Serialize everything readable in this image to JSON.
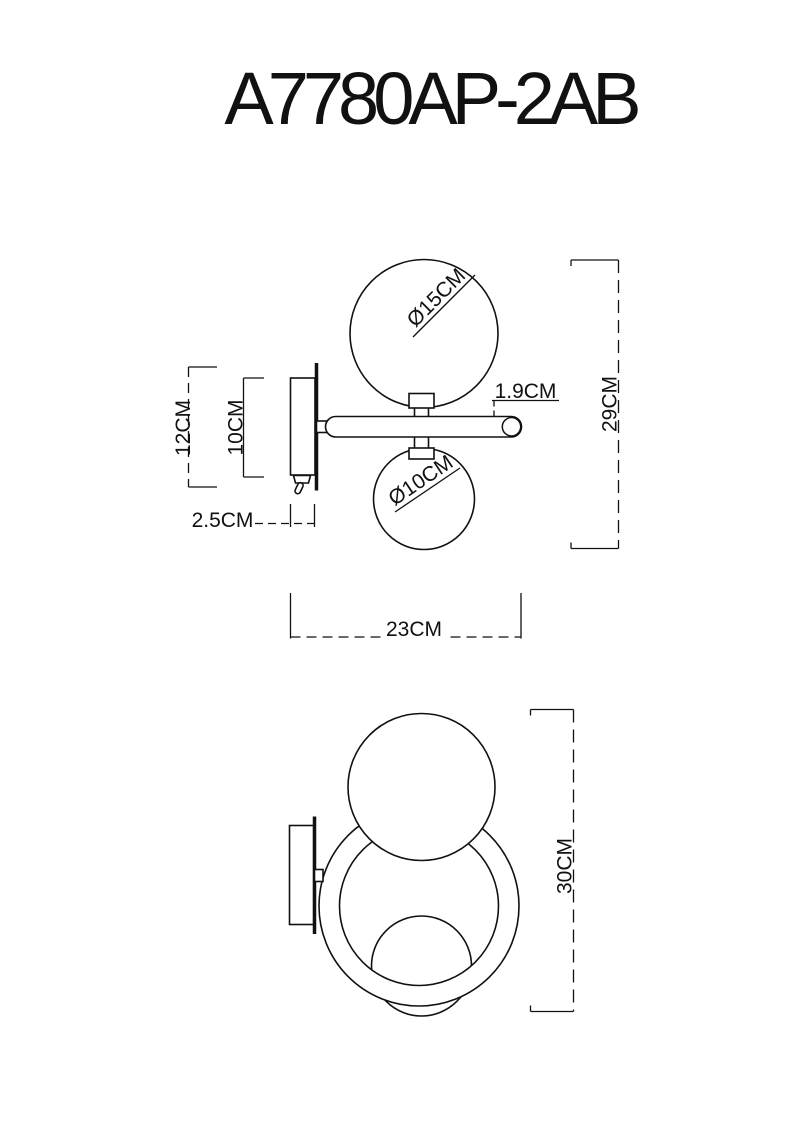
{
  "title": "A7780AP-2AB",
  "side_view": {
    "dimensions": {
      "backplate_height": "12CM",
      "plate_body_height": "10CM",
      "plate_depth": "2.5CM",
      "arm_diameter": "1.9CM",
      "overall_height": "29CM",
      "overall_projection": "23CM",
      "large_globe_diameter": "Ø15CM",
      "small_globe_diameter": "Ø10CM"
    }
  },
  "front_view": {
    "dimensions": {
      "overall_height": "30CM"
    }
  },
  "colors": {
    "line": "#111111",
    "background": "#ffffff"
  }
}
